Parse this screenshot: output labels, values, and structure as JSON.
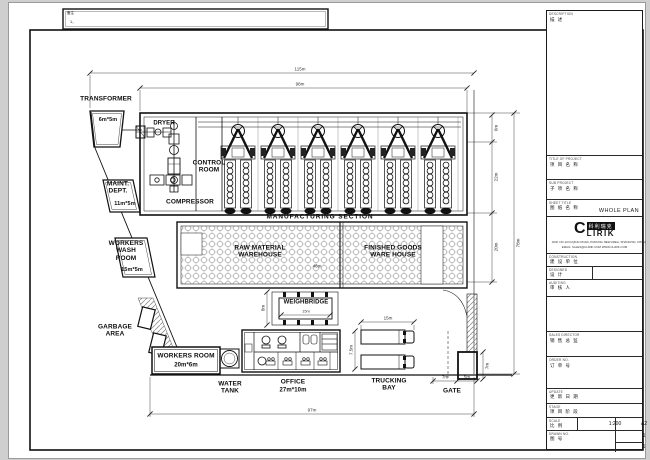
{
  "sheet": {
    "notes_line1": "备注",
    "notes_line2": "1、"
  },
  "plan": {
    "mill_count": 6,
    "labels": {
      "transformer": "TRANSFORMER",
      "transformer_size": "6m*5m",
      "dryer": "DRYER",
      "control_room": "CONTROL\nROOM",
      "compressor": "COMPRESSOR",
      "maint_dept": "MAINT.\nDEPT.",
      "maint_size": "11m*5m",
      "wash_room": "WORKERS\nWASH\nROOM",
      "wash_size": "15m*5m",
      "garbage": "GARBAGE\nAREA",
      "workers_room": "WORKERS ROOM",
      "workers_size": "20m*6m",
      "water_tank": "WATER\nTANK",
      "office": "OFFICE",
      "office_size": "27m*10m",
      "trucking": "TRUCKING\nBAY",
      "gate": "GATE",
      "weighbridge": "WEIGHBRIDGE",
      "manufacturing": "MANUFACTURING SECTION",
      "raw_wh": "RAW MATERIAL\nWAREHOUSE",
      "fin_wh": "FINISHED GOODS\nWARE HOUSE"
    },
    "dims": {
      "top_overall": "115m",
      "top_inner": "98m",
      "bottom": "97m",
      "right_band": "6m",
      "right_mill": "22m",
      "right_wh": "20m",
      "right_overall": "78m",
      "wh_inner": "46m",
      "weigh_w": "15m",
      "weigh_h": "8m",
      "truck_w": "15m",
      "truck_h": "7.5m",
      "gate_w": "7m",
      "guard_w": "5m",
      "guard_h": "7m"
    }
  },
  "title_block": {
    "description": {
      "label": "DESCRIPTION",
      "value": "描 述"
    },
    "project": {
      "label": "TITLE OF PROJECT",
      "value": "项 目 名 称"
    },
    "sub_project": {
      "label": "SUB PROJECT",
      "value": "子 项 名 称"
    },
    "sheet_title": {
      "label": "SHEET TITLE",
      "value": "图 纸 名 称",
      "name": "WHOLE PLAN"
    },
    "logo": {
      "c": "C",
      "lirik": "LIRIK",
      "cn": "科利瑞克",
      "addr1": "ADD: NO.19 FUQING ROAD, PUDONG NEW AREA, SHANGHAI, CHINA",
      "addr2": "EMAIL: SALES@CLIRIK.COM   WWW.CLIRIK.COM"
    },
    "construction": {
      "label": "CONSTRUCTION",
      "value": "建 设 单 位"
    },
    "designed": {
      "label": "DESIGNED",
      "value": "设 计"
    },
    "auditing": {
      "label": "AUDITING",
      "value": "审 核 人"
    },
    "sales_director": {
      "label": "SALES DIRECTOR",
      "value": "销 售 总 监"
    },
    "order_no": {
      "label": "ORDER NO.",
      "value": "订 单 号"
    },
    "update": {
      "label": "UPDATE",
      "value": "更 新 日 期"
    },
    "stage": {
      "label": "STAGE",
      "value": "项 目 阶 段"
    },
    "scale": {
      "label": "SCALE",
      "value": "比 例",
      "ratio": "1:200",
      "paper": "A2"
    },
    "drawn_no": {
      "label": "DRAWN NO.",
      "value": "图 号",
      "sheet": "1",
      "of": "1"
    }
  }
}
